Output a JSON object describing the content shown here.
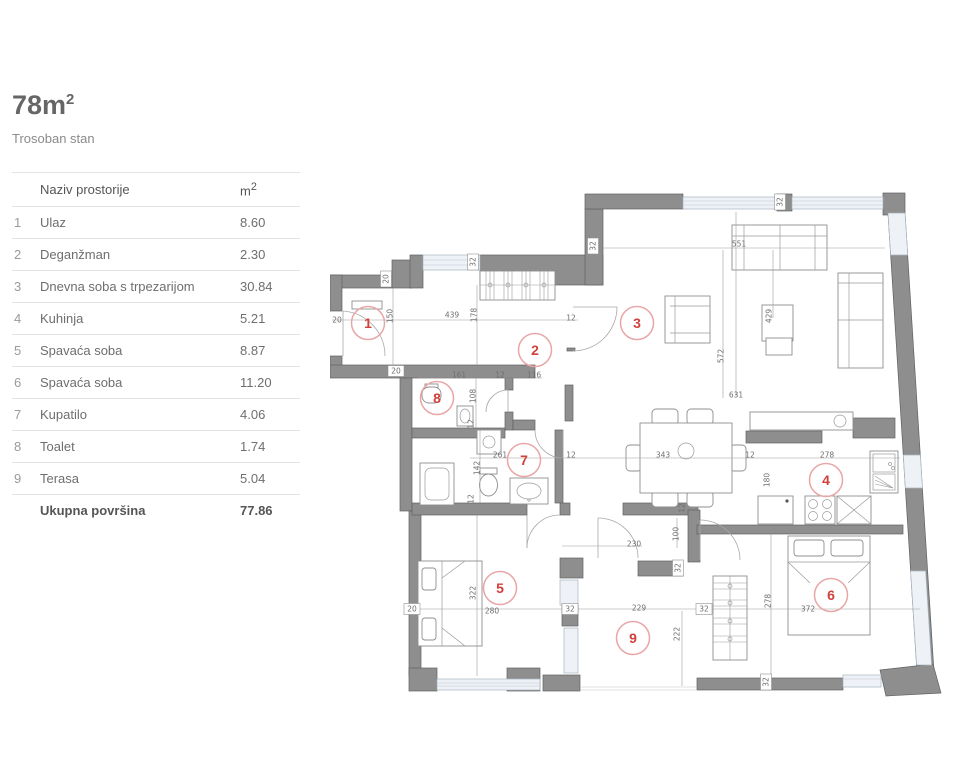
{
  "header": {
    "title_value": "78m",
    "title_sup": "2",
    "subtitle": "Trosoban stan"
  },
  "table": {
    "col_name": "Naziv prostorije",
    "col_unit": "m",
    "col_unit_sup": "2",
    "rows": [
      {
        "num": "1",
        "name": "Ulaz",
        "area": "8.60"
      },
      {
        "num": "2",
        "name": "Deganžman",
        "area": "2.30"
      },
      {
        "num": "3",
        "name": "Dnevna soba s trpezarijom",
        "area": "30.84"
      },
      {
        "num": "4",
        "name": "Kuhinja",
        "area": "5.21"
      },
      {
        "num": "5",
        "name": "Spavaća soba",
        "area": "8.87"
      },
      {
        "num": "6",
        "name": "Spavaća soba",
        "area": "11.20"
      },
      {
        "num": "7",
        "name": "Kupatilo",
        "area": "4.06"
      },
      {
        "num": "8",
        "name": "Toalet",
        "area": "1.74"
      },
      {
        "num": "9",
        "name": "Terasa",
        "area": "5.04"
      }
    ],
    "total_label": "Ukupna površina",
    "total_value": "77.86"
  },
  "plan": {
    "colors": {
      "wall": "#8e8e8e",
      "window": "#eef2f6",
      "circle_ring": "#e9a6a6",
      "circle_text": "#d2403c",
      "dim_text": "#6f6f6f"
    },
    "rooms": [
      {
        "n": "1",
        "x": 38,
        "y": 155
      },
      {
        "n": "2",
        "x": 205,
        "y": 182
      },
      {
        "n": "3",
        "x": 307,
        "y": 155
      },
      {
        "n": "4",
        "x": 496,
        "y": 312
      },
      {
        "n": "5",
        "x": 170,
        "y": 420
      },
      {
        "n": "6",
        "x": 501,
        "y": 427
      },
      {
        "n": "7",
        "x": 194,
        "y": 292
      },
      {
        "n": "8",
        "x": 107,
        "y": 230
      },
      {
        "n": "9",
        "x": 303,
        "y": 470
      }
    ],
    "dims": [
      {
        "t": "20",
        "x": 7,
        "y": 152
      },
      {
        "t": "150",
        "x": 60,
        "y": 148,
        "rot": 1
      },
      {
        "t": "439",
        "x": 122,
        "y": 147
      },
      {
        "t": "178",
        "x": 144,
        "y": 147,
        "rot": 1
      },
      {
        "t": "12",
        "x": 241,
        "y": 150
      },
      {
        "t": "551",
        "x": 409,
        "y": 76
      },
      {
        "t": "429",
        "x": 439,
        "y": 148,
        "rot": 1
      },
      {
        "t": "572",
        "x": 391,
        "y": 188,
        "rot": 1
      },
      {
        "t": "631",
        "x": 406,
        "y": 227
      },
      {
        "t": "161",
        "x": 129,
        "y": 207
      },
      {
        "t": "12",
        "x": 170,
        "y": 207
      },
      {
        "t": "116",
        "x": 204,
        "y": 207
      },
      {
        "t": "108",
        "x": 143,
        "y": 228,
        "rot": 1
      },
      {
        "t": "261",
        "x": 170,
        "y": 287
      },
      {
        "t": "12",
        "x": 241,
        "y": 287
      },
      {
        "t": "343",
        "x": 333,
        "y": 287
      },
      {
        "t": "12",
        "x": 420,
        "y": 287
      },
      {
        "t": "278",
        "x": 497,
        "y": 287
      },
      {
        "t": "180",
        "x": 437,
        "y": 312,
        "rot": 1
      },
      {
        "t": "142",
        "x": 147,
        "y": 300,
        "rot": 1
      },
      {
        "t": "12",
        "x": 141,
        "y": 256,
        "rot": 1
      },
      {
        "t": "12",
        "x": 141,
        "y": 331,
        "rot": 1
      },
      {
        "t": "12",
        "x": 352,
        "y": 340,
        "rot": 1
      },
      {
        "t": "230",
        "x": 304,
        "y": 376
      },
      {
        "t": "100",
        "x": 346,
        "y": 366,
        "rot": 1
      },
      {
        "t": "280",
        "x": 162,
        "y": 443
      },
      {
        "t": "322",
        "x": 143,
        "y": 425,
        "rot": 1
      },
      {
        "t": "229",
        "x": 309,
        "y": 440
      },
      {
        "t": "372",
        "x": 478,
        "y": 441
      },
      {
        "t": "278",
        "x": 438,
        "y": 433,
        "rot": 1
      },
      {
        "t": "222",
        "x": 347,
        "y": 466,
        "rot": 1
      },
      {
        "t": "32",
        "x": 143,
        "y": 94,
        "rot": 1,
        "box": 1
      },
      {
        "t": "32",
        "x": 263,
        "y": 78,
        "rot": 1,
        "box": 1
      },
      {
        "t": "32",
        "x": 450,
        "y": 34,
        "rot": 1,
        "box": 1
      },
      {
        "t": "20",
        "x": 56,
        "y": 111,
        "rot": 1,
        "box": 1
      },
      {
        "t": "20",
        "x": 66,
        "y": 203,
        "box": 1
      },
      {
        "t": "32",
        "x": 348,
        "y": 400,
        "rot": 1,
        "box": 1
      },
      {
        "t": "20",
        "x": 82,
        "y": 441,
        "box": 1
      },
      {
        "t": "32",
        "x": 240,
        "y": 441,
        "box": 1
      },
      {
        "t": "32",
        "x": 374,
        "y": 441,
        "box": 1
      },
      {
        "t": "32",
        "x": 436,
        "y": 514,
        "rot": 1,
        "box": 1
      }
    ]
  }
}
